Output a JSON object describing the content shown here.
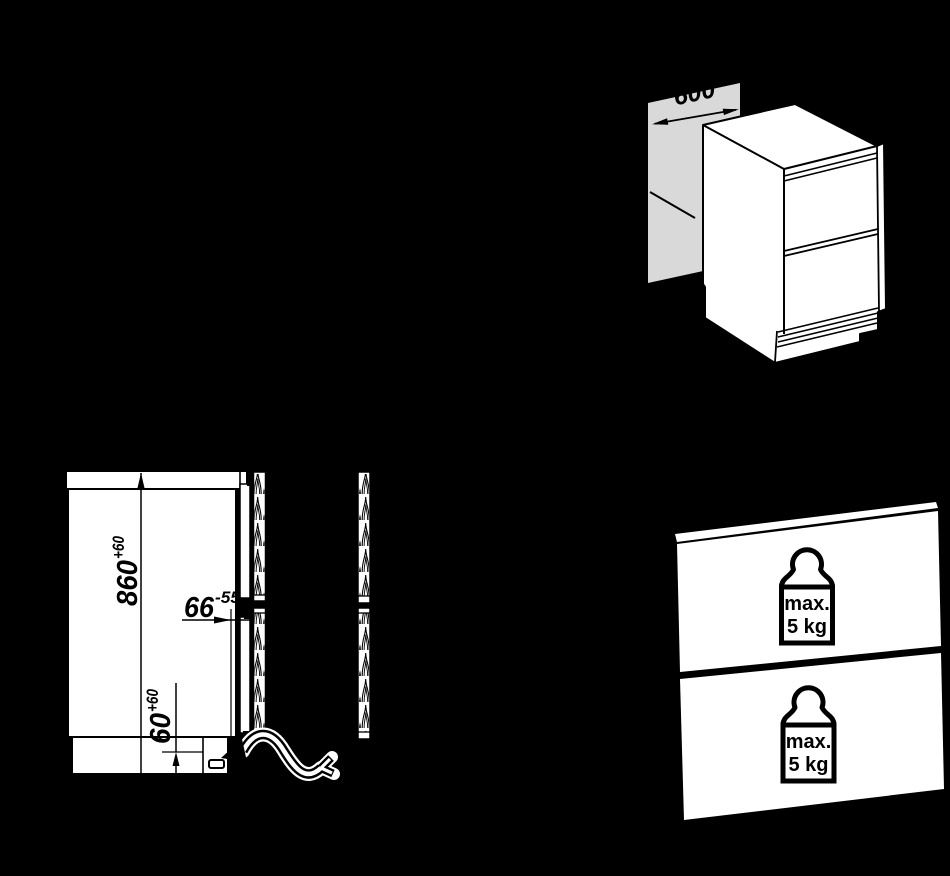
{
  "colors": {
    "background": "#000000",
    "linework": "#000000",
    "shape_fill": "#ffffff",
    "niche_panel_gray": "#d9d9d9"
  },
  "isometric_view": {
    "niche_width_dim": {
      "value": "600"
    }
  },
  "side_elevation": {
    "niche_height_dim": {
      "value": "860",
      "tolerance": "+60"
    },
    "front_clearance_dim": {
      "value": "66",
      "tolerance": "-55"
    },
    "plinth_dim": {
      "value": "60",
      "tolerance": "+60"
    }
  },
  "front_panel_view": {
    "upper_panel_weight": {
      "label": "max.",
      "amount": "5 kg"
    },
    "lower_panel_weight": {
      "label": "max.",
      "amount": "5 kg"
    }
  },
  "icons": {
    "weight": "weight-icon",
    "cable": "power-cable-arrow-icon"
  }
}
